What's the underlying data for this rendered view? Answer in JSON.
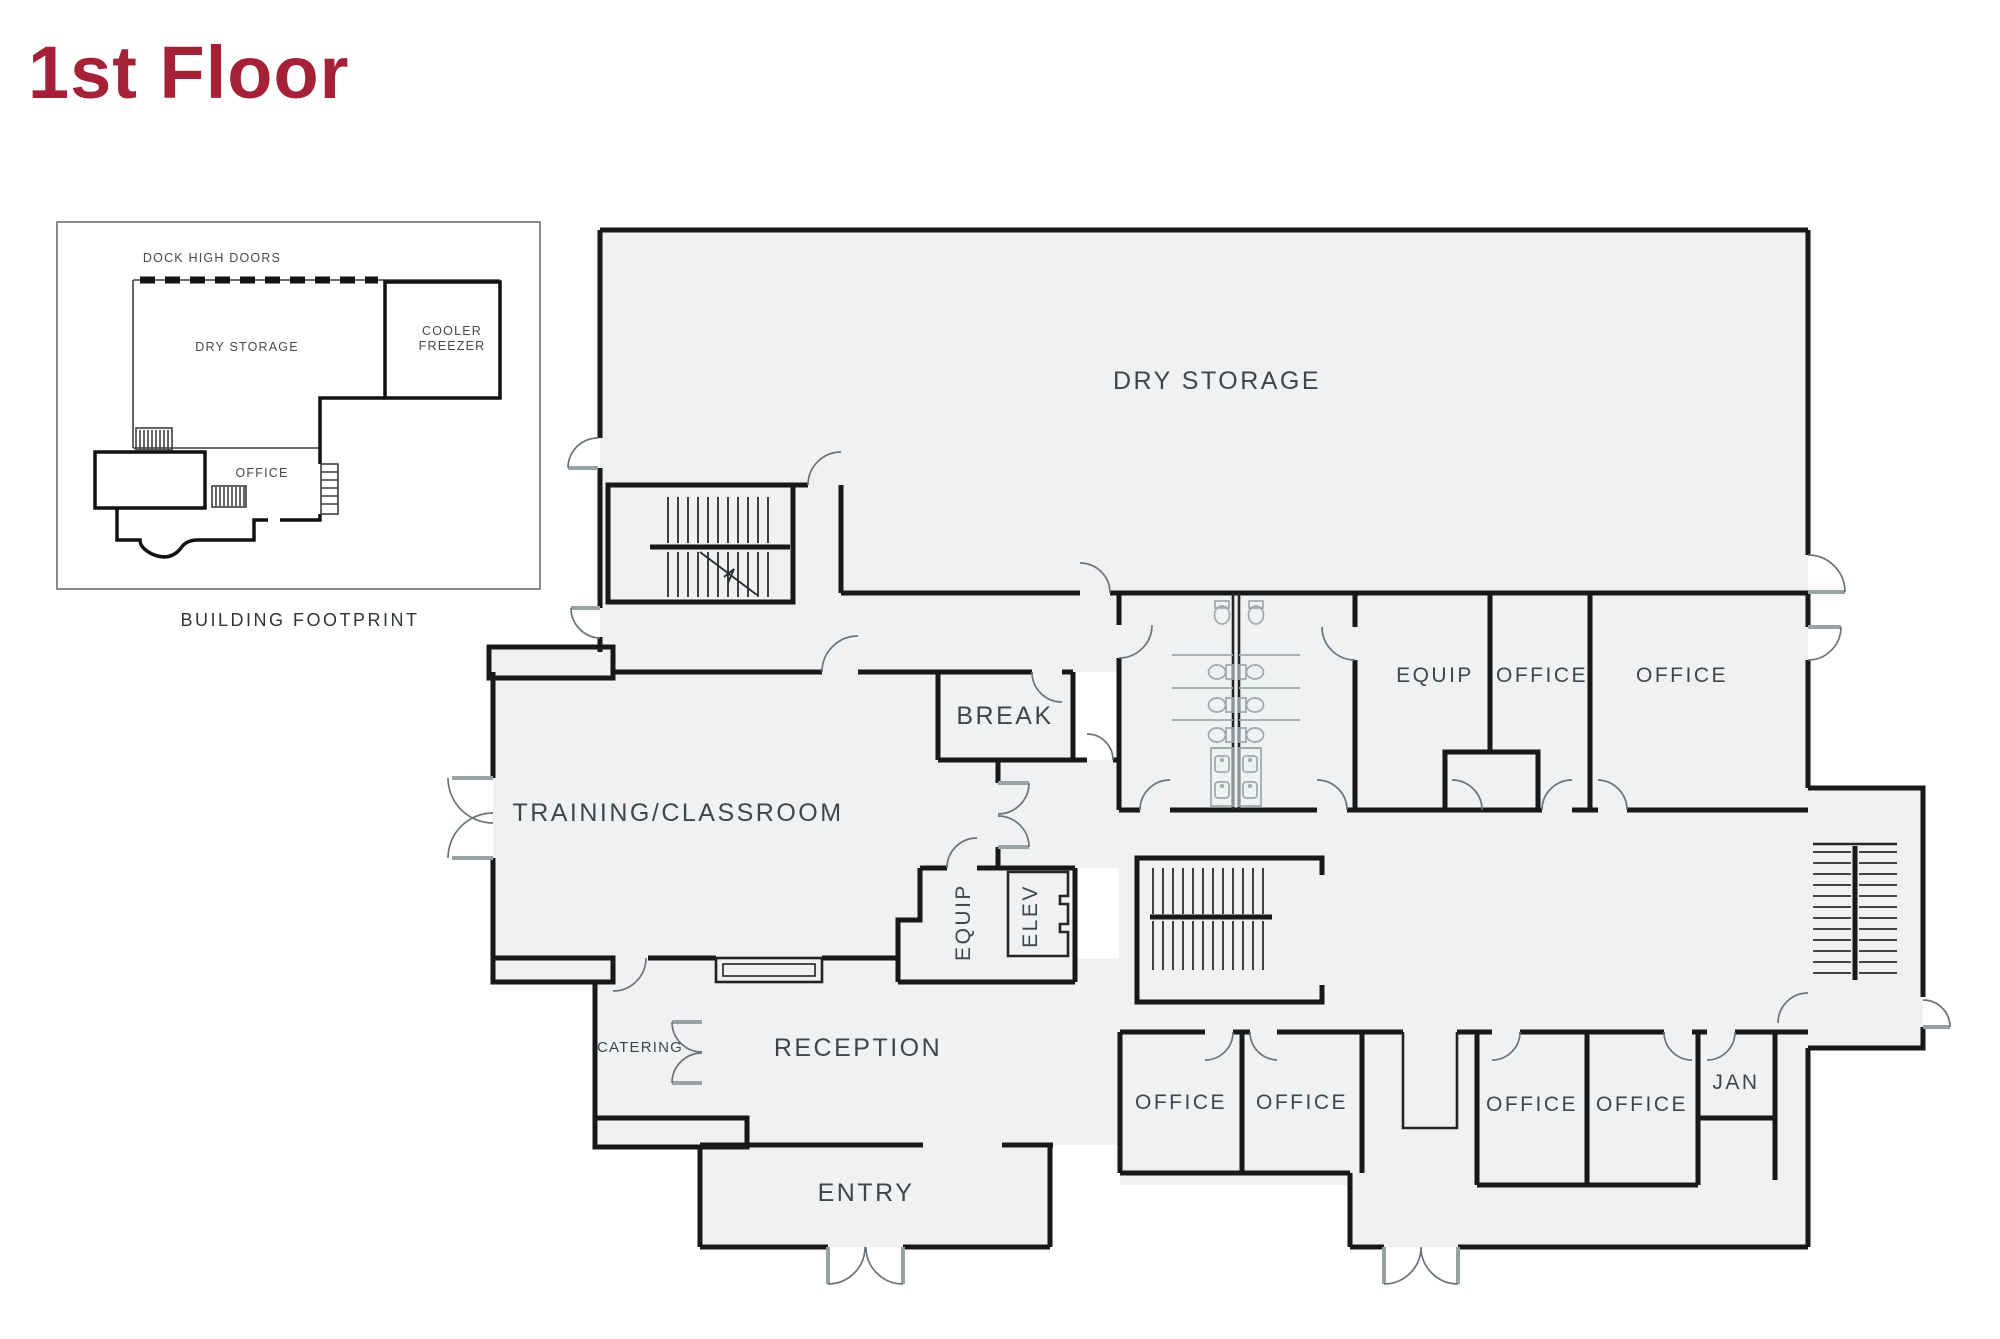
{
  "title": "1st Floor",
  "inset": {
    "caption": "BUILDING FOOTPRINT",
    "dock_label": "DOCK HIGH DOORS",
    "dry_storage_label": "DRY STORAGE",
    "cooler_label_line1": "COOLER",
    "cooler_label_line2": "FREEZER",
    "office_label": "OFFICE"
  },
  "plan": {
    "dry_storage": "DRY STORAGE",
    "break_room": "BREAK",
    "training": "TRAINING/CLASSROOM",
    "equip_core": "EQUIP",
    "elevator": "ELEV",
    "catering": "CATERING",
    "reception": "RECEPTION",
    "entry": "ENTRY",
    "equip_row": "EQUIP",
    "office": "OFFICE",
    "jan": "JAN"
  },
  "colors": {
    "accent": "#A42138",
    "floor": "#EFF1F2",
    "wall": "#16181a",
    "label": "#3F464A",
    "door_leaf": "#98A2A4"
  }
}
